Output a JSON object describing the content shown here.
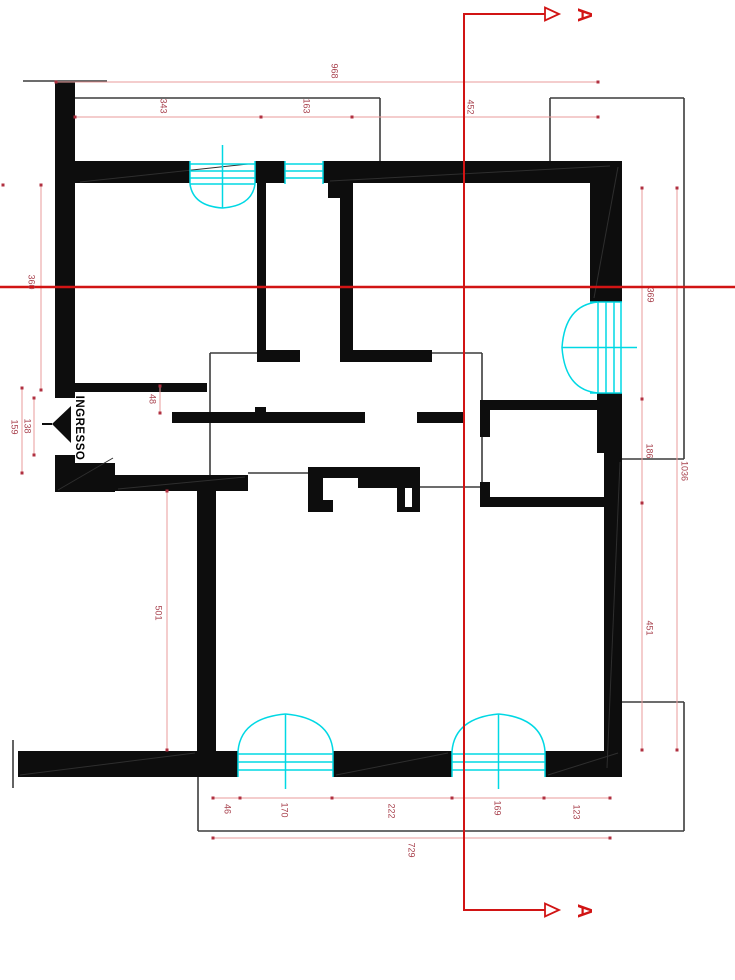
{
  "drawing": {
    "type": "architectural-floor-plan",
    "room_labels": {
      "entrance": "INGRESSO"
    },
    "section_marker": {
      "label": "A"
    },
    "dimensions": {
      "top_total": "968",
      "top_a": "343",
      "top_b": "163",
      "top_c": "452",
      "left_upper": "360",
      "entry_door": "138",
      "entry_opening": "159",
      "hall_offset": "48",
      "left_lower": "501",
      "bottom_a": "46",
      "bottom_b": "170",
      "bottom_c": "222",
      "bottom_d": "169",
      "bottom_e": "123",
      "bottom_total": "729",
      "right_a": "369",
      "right_b": "186",
      "right_c": "451",
      "right_total": "1036"
    },
    "colors": {
      "wall": "#0d0d0d",
      "fixture": "#00d8e4",
      "section": "#d11414",
      "dimension": "#e89b9b",
      "label": "#a8424e"
    }
  }
}
